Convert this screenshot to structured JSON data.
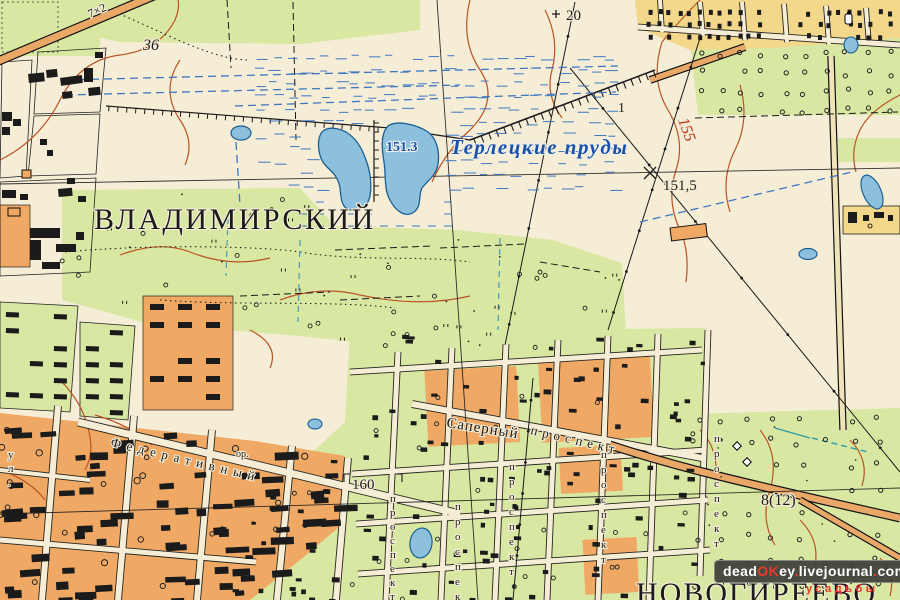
{
  "map": {
    "description": "Soviet topographic map sheet, Terletsky ponds / Vladimirsky / Novogireevo area",
    "colors": {
      "background": "#f5edd6",
      "vegetation_green": "#d8e7a2",
      "urban_orange": "#efa964",
      "suburban_yellow": "#f3d78a",
      "water_fill": "#8cc0dc",
      "water_edge": "#1d5f94",
      "contour_brown": "#b95326",
      "red_label": "#c03420",
      "blue_label": "#1c50a8",
      "ink_black": "#1b1b1b",
      "watermark_bg": "#3e3e38",
      "watermark_red": "#e8392e"
    },
    "place_labels": {
      "district": "ВЛАДИМИРСКИЙ",
      "settlement": "НОВОГИРЕЕВО",
      "ponds_name": "Терлецкие пруды"
    },
    "elevation_labels": {
      "pond_water_level": "151.3",
      "spot_height": "151,5",
      "contour_155": "155",
      "height_160": "160",
      "height_36": "36"
    },
    "road_labels": {
      "road_width_top": "7×2",
      "road_width_bottom": "8(12)",
      "power_line_20": "20",
      "embankment_1": "1"
    },
    "street_labels": {
      "federativny": "Федеративный",
      "saperny": "Саперный",
      "prospekt_diag": "проспект",
      "or_abbrev": "ор.",
      "vertical_1": "проспект",
      "vertical_2": "проспект",
      "vertical_3": "проспект",
      "vertical_4": "проспект",
      "vertical_5": "проспект",
      "vertical_6": "ул."
    },
    "watermark": {
      "segments": [
        {
          "text": "dead",
          "color": "#ffffff"
        },
        {
          "text": "OK",
          "color": "#e8392e"
        },
        {
          "text": "ey",
          "color": "#ffffff"
        },
        {
          "text": ".",
          "color": "#e8392e"
        },
        {
          "text": "livejournal",
          "color": "#ffffff"
        },
        {
          "text": ".",
          "color": "#e8392e"
        },
        {
          "text": "com",
          "color": "#ffffff"
        }
      ],
      "caption": "усадьбы"
    }
  }
}
